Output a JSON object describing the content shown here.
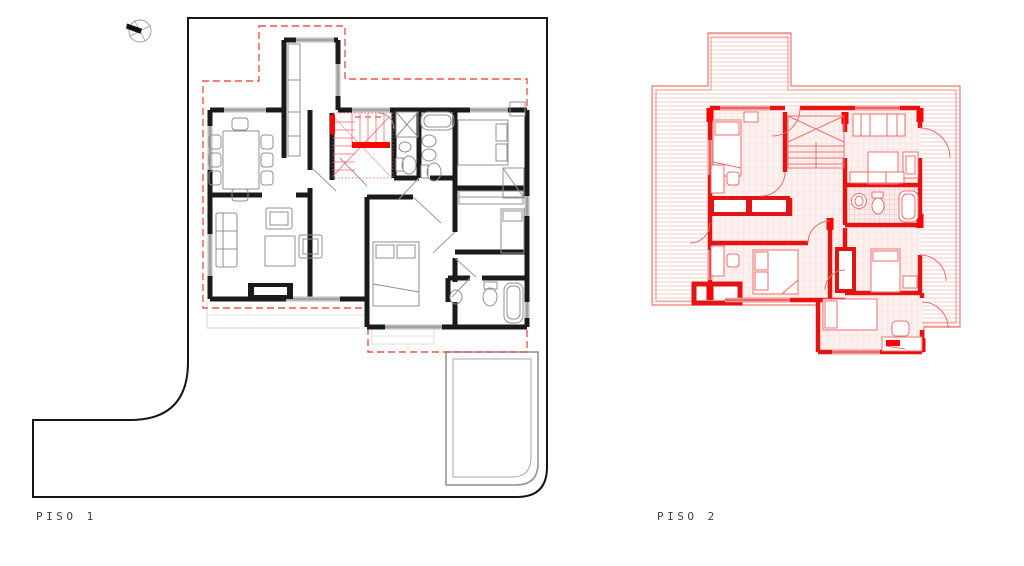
{
  "background": "#ffffff",
  "plans": [
    {
      "id": "piso-1",
      "label": "PISO 1",
      "colors": {
        "linework": "#1a1a1a",
        "site_boundary": "#151515",
        "setback_dashed": "#f2554a",
        "stair_accent": "#fe0505",
        "furniture": "#909090",
        "window": "#bdbdbd",
        "terrace": "#d9d9d9"
      }
    },
    {
      "id": "piso-2",
      "label": "PISO 2",
      "colors": {
        "walls": "#e31414",
        "accent": "#fb0303",
        "furniture": "#ef6e6a",
        "roof_outline": "#ea7a74",
        "roof_hatch": "#f5c4c2",
        "floor_grid": "#f7d9d7",
        "window": "#f59b97"
      }
    }
  ],
  "icons": [
    {
      "name": "north-compass-icon"
    }
  ]
}
